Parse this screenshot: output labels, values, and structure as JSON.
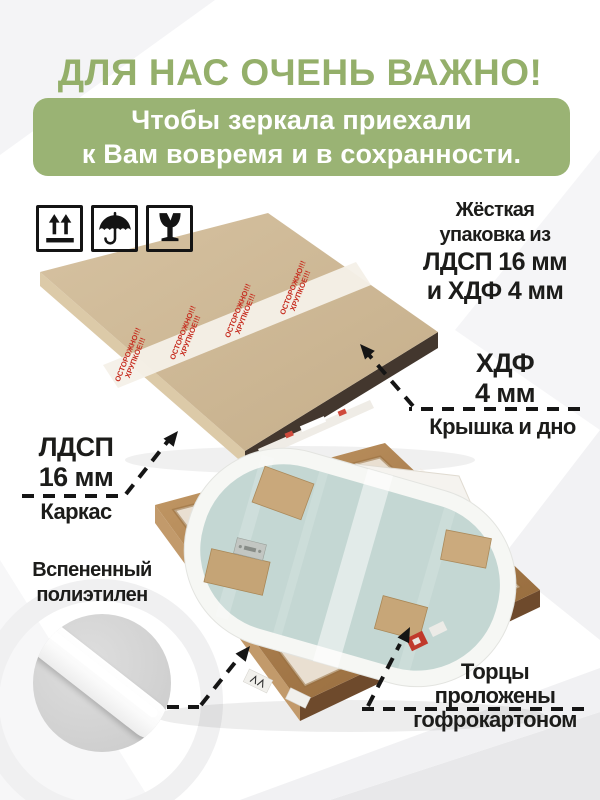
{
  "colors": {
    "brand_green_text": "#94af6a",
    "brand_green_bg": "#9ab374",
    "tape_red": "#c62b1e",
    "ink": "#1c1c1a",
    "kraft": "#ccb695",
    "mirror_glass": "#c4d7d3",
    "wood": "#ad8051"
  },
  "header": {
    "title": "ДЛЯ НАС ОЧЕНЬ ВАЖНО!",
    "banner_line1": "Чтобы зеркала приехали",
    "banner_line2": "к Вам вовремя и в сохранности."
  },
  "handling_icons": [
    {
      "name": "this-way-up-icon"
    },
    {
      "name": "keep-dry-icon"
    },
    {
      "name": "fragile-icon"
    }
  ],
  "tape": {
    "line1": "ОСТОРОЖНО!!!",
    "line2": "ХРУПКОЕ!!!"
  },
  "callouts": {
    "rigid": {
      "line1": "Жёсткая",
      "line2": "упаковка из",
      "line3": "ЛДСП 16 мм",
      "line4": "и ХДФ 4 мм"
    },
    "hdf": {
      "title": "ХДФ",
      "size": "4 мм",
      "caption": "Крышка и дно"
    },
    "ldsp": {
      "title": "ЛДСП",
      "size": "16 мм",
      "caption": "Каркас"
    },
    "foam": {
      "line1": "Вспененный",
      "line2": "полиэтилен"
    },
    "edges": {
      "line1": "Торцы",
      "line2": "проложены",
      "line3": "гофрокартоном"
    }
  }
}
